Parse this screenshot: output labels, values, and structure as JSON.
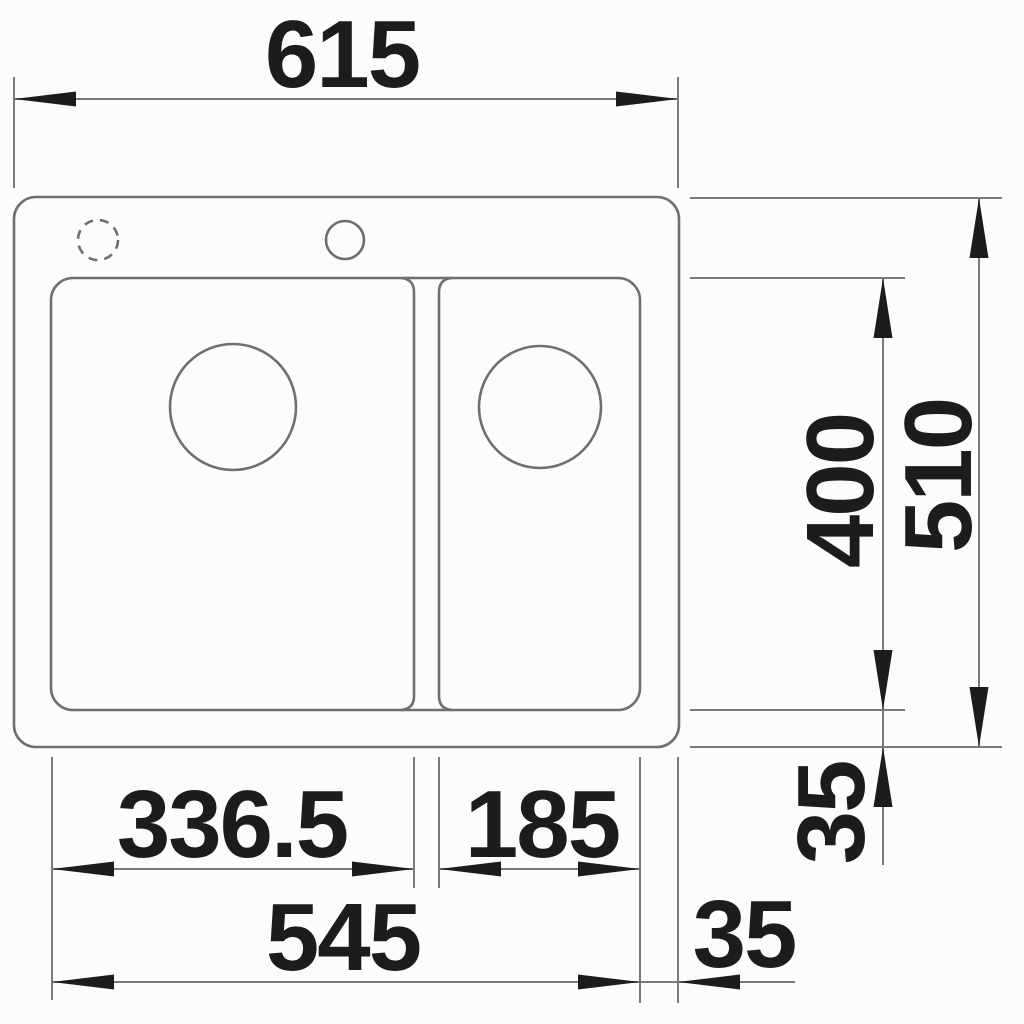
{
  "drawing": {
    "kind": "technical-dimension-drawing",
    "labels": {
      "top_overall_width": "615",
      "right_overall_depth": "510",
      "right_bowl_depth": "400",
      "right_bottom_offset": "35",
      "bottom_main_bowl_width": "336.5",
      "bottom_half_bowl_width": "185",
      "bottom_bowls_span": "545",
      "bottom_right_offset": "35"
    },
    "colors": {
      "background": "#fcfcfc",
      "outline": "#6f6f6f",
      "dimension_line": "#7a7a7a",
      "text": "#1c1c1c",
      "arrow": "#1c1c1c"
    }
  }
}
